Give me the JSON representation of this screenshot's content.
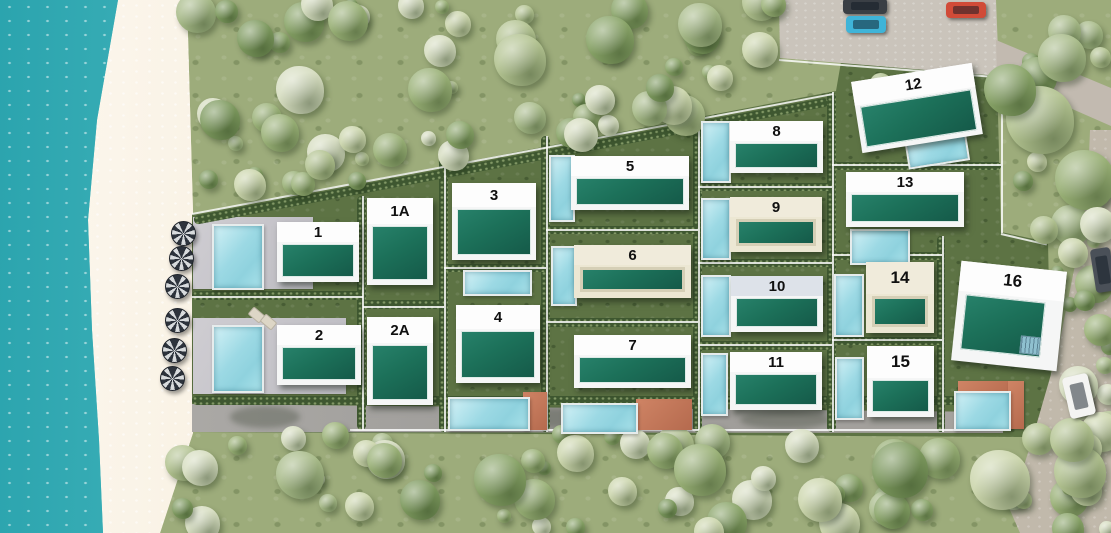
{
  "villas": [
    {
      "id": "villa-1",
      "label": "1",
      "variant": "white"
    },
    {
      "id": "villa-1a",
      "label": "1A",
      "variant": "white"
    },
    {
      "id": "villa-2",
      "label": "2",
      "variant": "white"
    },
    {
      "id": "villa-2a",
      "label": "2A",
      "variant": "white"
    },
    {
      "id": "villa-3",
      "label": "3",
      "variant": "white"
    },
    {
      "id": "villa-4",
      "label": "4",
      "variant": "white"
    },
    {
      "id": "villa-5",
      "label": "5",
      "variant": "white"
    },
    {
      "id": "villa-6",
      "label": "6",
      "variant": "cream"
    },
    {
      "id": "villa-7",
      "label": "7",
      "variant": "white"
    },
    {
      "id": "villa-8",
      "label": "8",
      "variant": "white"
    },
    {
      "id": "villa-9",
      "label": "9",
      "variant": "cream"
    },
    {
      "id": "villa-10",
      "label": "10",
      "variant": "gray"
    },
    {
      "id": "villa-11",
      "label": "11",
      "variant": "white"
    },
    {
      "id": "villa-12",
      "label": "12",
      "variant": "white"
    },
    {
      "id": "villa-13",
      "label": "13",
      "variant": "white"
    },
    {
      "id": "villa-14",
      "label": "14",
      "variant": "cream"
    },
    {
      "id": "villa-15",
      "label": "15",
      "variant": "white"
    },
    {
      "id": "villa-16",
      "label": "16",
      "variant": "white"
    }
  ],
  "site": {
    "beach_umbrella_count": 6,
    "parking_car_colors": [
      "#3a3f45",
      "#3fb4d8",
      "#d14b38"
    ],
    "road_car_colors": [
      "#f4f4f2",
      "#4a5058"
    ],
    "palette": {
      "ocean": "#4fbcc2",
      "sand": "#f2e8d6",
      "wild_green": "#9dac7b",
      "lot_lawn": "#5d7344",
      "roof_green": "#1c7059",
      "building_white": "#f5f6f6",
      "building_cream": "#ece7d3",
      "band_gray": "#dde2e9",
      "pool_blue": "#9cd9e4",
      "terracotta": "#c07a5b",
      "road": "#c1b9ab",
      "parking": "#cac4bb"
    }
  }
}
